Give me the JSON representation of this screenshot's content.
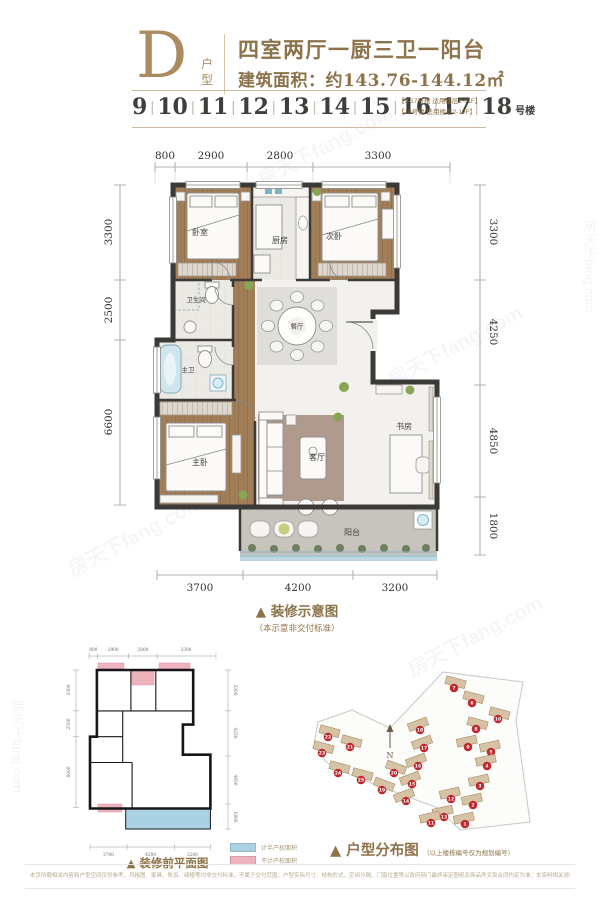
{
  "header": {
    "plan_letter": "D",
    "plan_letter_label": "户型",
    "title": "四室两厅一厨三卫一阳台",
    "area_line": "建筑面积：约143.76-144.12㎡",
    "building_numbers": [
      "9",
      "10",
      "11",
      "12",
      "13",
      "14",
      "15",
      "16",
      "17",
      "18"
    ],
    "building_suffix": "号楼",
    "floor_notes": [
      "【9-17号楼 适用楼层2-11F】",
      "【18号楼 适用楼层2-10F】"
    ]
  },
  "main_plan": {
    "dims_top": [
      "800",
      "2900",
      "2800",
      "3300"
    ],
    "dims_left": [
      "3300",
      "2500",
      "6600"
    ],
    "dims_right": [
      "3300",
      "4250",
      "4850",
      "1800"
    ],
    "dims_bottom": [
      "3700",
      "4200",
      "3200"
    ],
    "rooms": {
      "bedroom": "卧室",
      "kitchen": "厨房",
      "bedroom2": "次卧",
      "bath": "卫生间",
      "master_bath": "主卫",
      "dining": "餐厅",
      "master_bedroom": "主卧",
      "living": "客厅",
      "study": "书房",
      "balcony": "阳台"
    },
    "caption": "▲ 装修示意图",
    "caption_sub": "（本示意非交付标准）"
  },
  "before_plan": {
    "caption": "▲ 装修前平面图",
    "legend": [
      {
        "color": "#aad2e4",
        "label": "计半产权面积"
      },
      {
        "color": "#efb3be",
        "label": "不计产权面积"
      }
    ]
  },
  "distribution": {
    "caption": "▲ 户型分布图",
    "caption_note": "（以上楼栋编号仅为规划编号）",
    "compass": "N",
    "buildings": [
      {
        "no": "7",
        "x": 156,
        "y": 36,
        "a": 15
      },
      {
        "no": "6",
        "x": 174,
        "y": 51,
        "a": 15
      },
      {
        "no": "10",
        "x": 200,
        "y": 67,
        "a": 15
      },
      {
        "no": "8",
        "x": 178,
        "y": 77,
        "a": 15
      },
      {
        "no": "9",
        "x": 170,
        "y": 95,
        "a": -12
      },
      {
        "no": "5",
        "x": 193,
        "y": 100,
        "a": -12
      },
      {
        "no": "4",
        "x": 189,
        "y": 114,
        "a": -12
      },
      {
        "no": "3",
        "x": 182,
        "y": 134,
        "a": -12
      },
      {
        "no": "2",
        "x": 175,
        "y": 153,
        "a": -12
      },
      {
        "no": "1",
        "x": 167,
        "y": 172,
        "a": -12
      },
      {
        "no": "18",
        "x": 122,
        "y": 78,
        "a": -20
      },
      {
        "no": "17",
        "x": 126,
        "y": 96,
        "a": -20
      },
      {
        "no": "16",
        "x": 120,
        "y": 114,
        "a": -20
      },
      {
        "no": "15",
        "x": 114,
        "y": 132,
        "a": -20
      },
      {
        "no": "14",
        "x": 108,
        "y": 149,
        "a": -20
      },
      {
        "no": "13",
        "x": 146,
        "y": 165,
        "a": -12
      },
      {
        "no": "12",
        "x": 153,
        "y": 147,
        "a": -12
      },
      {
        "no": "11",
        "x": 133,
        "y": 171,
        "a": -12
      },
      {
        "no": "19",
        "x": 84,
        "y": 138,
        "a": 20
      },
      {
        "no": "20",
        "x": 96,
        "y": 121,
        "a": 20
      },
      {
        "no": "25",
        "x": 63,
        "y": 128,
        "a": 15
      },
      {
        "no": "24",
        "x": 40,
        "y": 121,
        "a": 15
      },
      {
        "no": "23",
        "x": 24,
        "y": 101,
        "a": 15
      },
      {
        "no": "22",
        "x": 30,
        "y": 85,
        "a": 15
      },
      {
        "no": "21",
        "x": 52,
        "y": 95,
        "a": 15
      }
    ]
  },
  "footer": {
    "disclaimer": "本页所载相关内容和户型空间仅供参考，风格图、家具、陈设、绿植等均非交付标准，不属于交付范围；户型实际尺寸、结构形式、空间分隔、门窗位置等以政府部门最终审定图纸及商品房买卖合同约定为准；本资料相关说明、建议、数据等仅为示意，最终以政府有关部门批准文件及双方签订的商品房买卖合同为准。"
  },
  "watermark": "房天下fang.com",
  "colors": {
    "accent_gold": "#8d734a",
    "marker_red": "#c0272d",
    "balcony_blue": "#aad2e4",
    "highlight_pink": "#efb3be",
    "wood_floor": "#a07c57"
  }
}
